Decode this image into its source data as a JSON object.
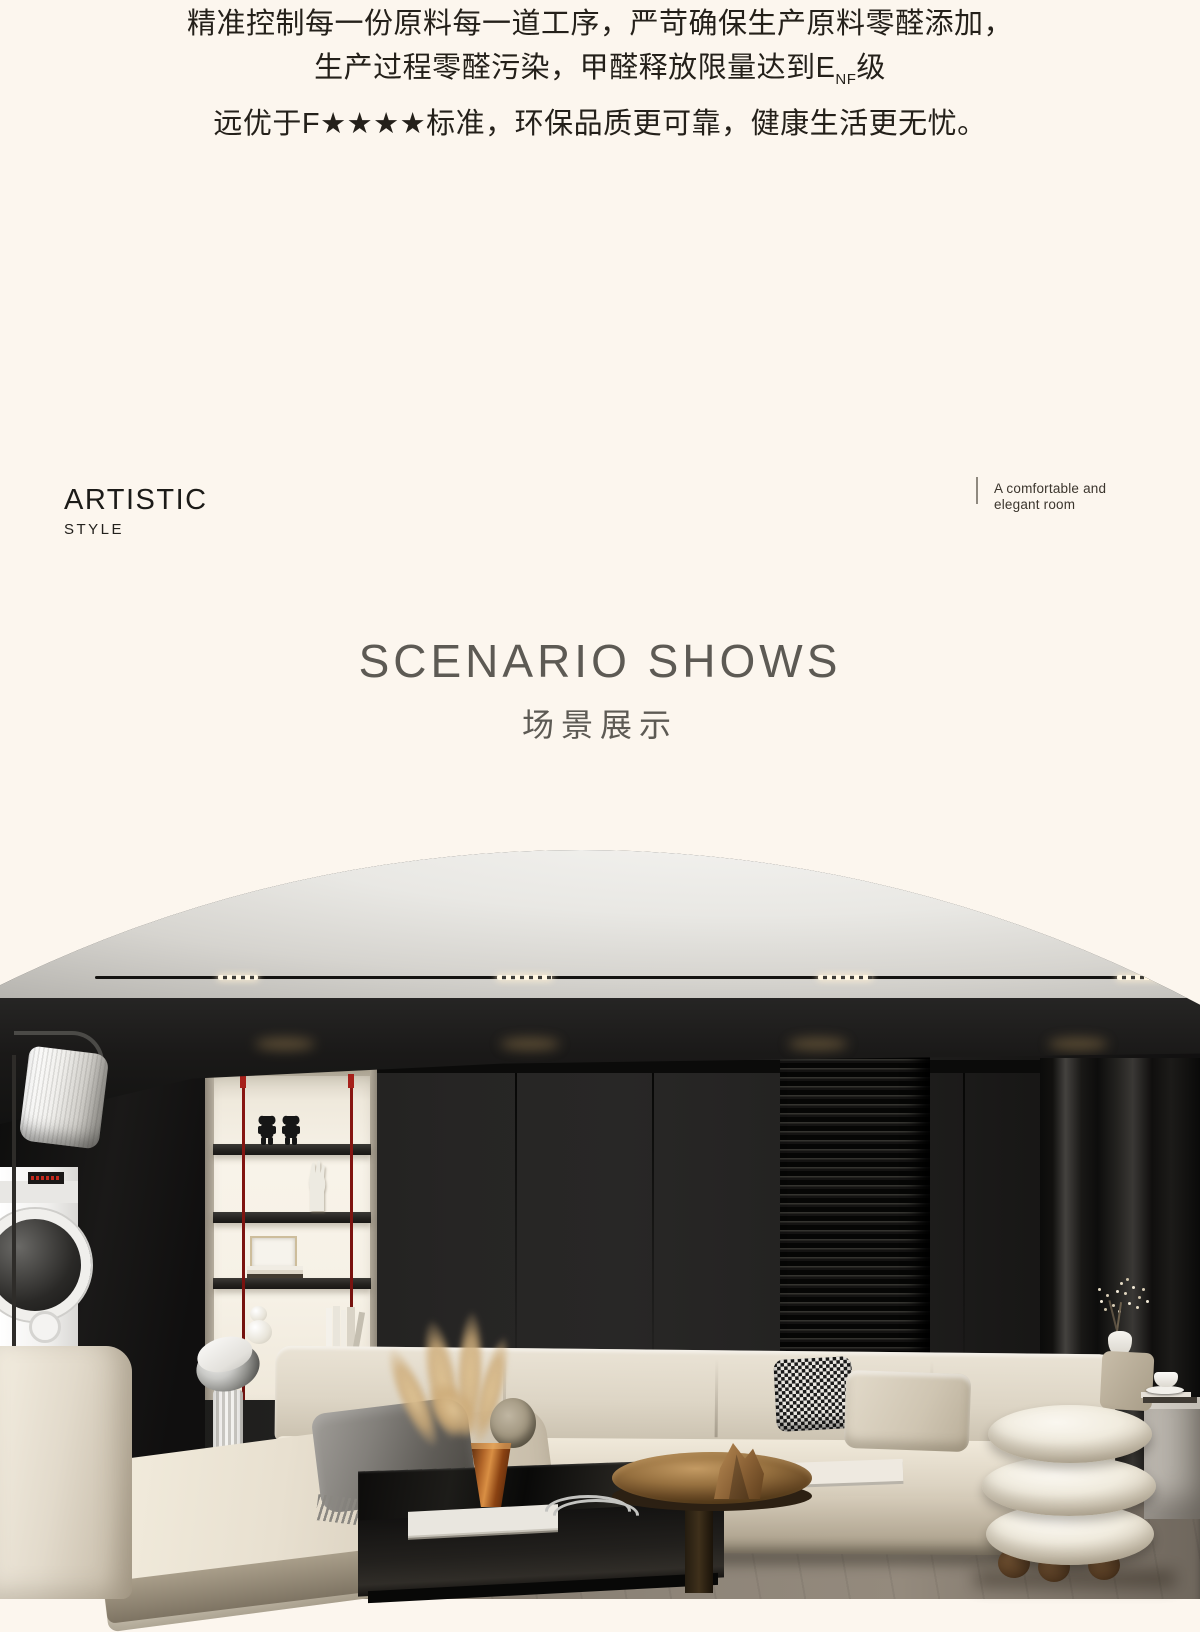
{
  "intro": {
    "line1": "精准控制每一份原料每一道工序，严苛确保生产原料零醛添加，",
    "line2_pre": "生产过程零醛污染，甲醛释放限量达到E",
    "line2_sub": "NF",
    "line2_post": "级",
    "line3": "远优于F★★★★标准，环保品质更可靠，健康生活更无忧。"
  },
  "style_block": {
    "title": "ARTISTIC",
    "subtitle": "STYLE"
  },
  "side_note": {
    "line1": "A comfortable and",
    "line2": "elegant room"
  },
  "section": {
    "title_en": "SCENARIO SHOWS",
    "title_zh": "场景展示"
  },
  "scene": {
    "label": "living-room-showcase",
    "colors": {
      "page_bg": "#fcf6ee",
      "text_dark": "#24201a",
      "heading_gray": "#5d5a54",
      "ceiling_light": "#efeeeb",
      "wall_dark": "#1e1d1c",
      "niche_cream": "#f6f1e6",
      "accent_red_cord": "#7a1512",
      "sofa_beige": "#ded6c7",
      "pouf_white": "#f2eee5",
      "bronze": "#96703f",
      "amber_glass": "#b06428",
      "floor_taupe": "#877d70"
    }
  }
}
